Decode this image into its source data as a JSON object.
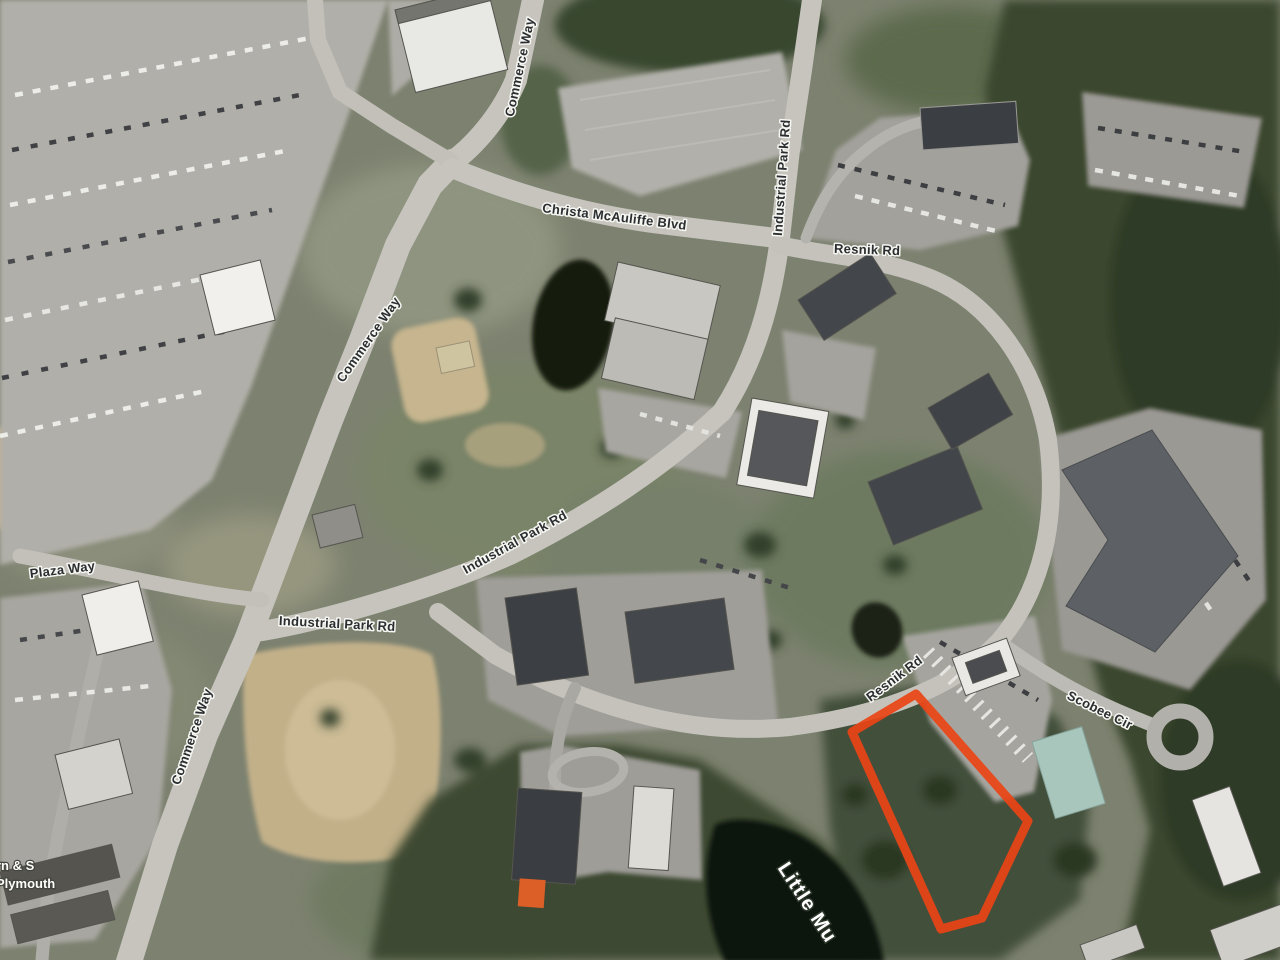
{
  "map": {
    "labels": {
      "commerce_way": "Commerce Way",
      "christa_mcauliffe_blvd": "Christa McAuliffe Blvd",
      "industrial_park_rd": "Industrial Park Rd",
      "resnik_rd": "Resnik Rd",
      "scobee_cir": "Scobee Cir",
      "plaza_way": "Plaza Way",
      "water": "Little Mu",
      "poi_line1": "rn & S",
      "poi_line2": "Plymouth"
    },
    "highlight": {
      "color": "#ea4517",
      "stroke_width": "9",
      "points": "852,732 916,694 1028,821 982,918 941,929"
    }
  }
}
